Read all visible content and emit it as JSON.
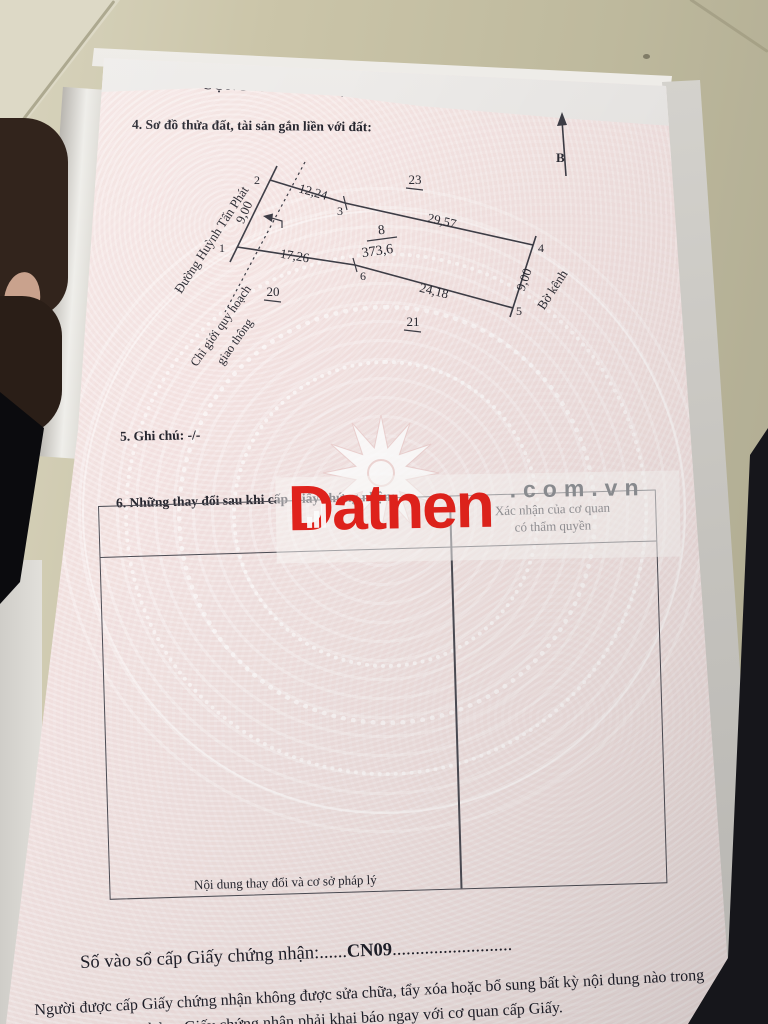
{
  "document": {
    "header_partial": "CỘNG HOÀ XÃ HỘI CHỦ NGHĨA VIỆT NAM",
    "section4": {
      "title": "4. Sơ đồ thửa đất, tài sản gắn liền với đất:"
    },
    "section5": {
      "label": "5. Ghi chú:",
      "value": "-/-"
    },
    "section6": {
      "title": "6. Những thay đổi sau khi cấp Giấy chứng nhận:",
      "table": {
        "col1_header": "Nội dung thay đổi và cơ sở pháp lý",
        "col2_header_line1": "Xác nhận của cơ quan",
        "col2_header_line2": "có thẩm quyền"
      }
    },
    "footer": {
      "registry_label": "Số vào sổ cấp Giấy chứng nhận:",
      "registry_dots_before": "......",
      "registry_number": "CN09",
      "registry_dots_after": "..........................",
      "notice_line1": "Người được cấp Giấy chứng nhận không được sửa chữa, tẩy xóa hoặc bổ sung bất kỳ nội dung nào trong",
      "notice_line2_partial": "hỏng Giấy chứng nhận phải khai báo ngay với cơ quan cấp Giấy."
    }
  },
  "diagram": {
    "north_label": "B",
    "road_label": "Đường Huỳnh Tấn Phát",
    "canal_label": "Bờ kênh",
    "planning_line1": "Chỉ giới quy hoạch",
    "planning_line2": "giao thông",
    "parcel": {
      "number": "8",
      "area": "373,6"
    },
    "points": {
      "p1": "1",
      "p2": "2",
      "p3": "3",
      "p4": "4",
      "p5": "5",
      "p6": "6"
    },
    "lengths": {
      "top1": "12,24",
      "top2": "29,57",
      "bottom1": "17,26",
      "bottom2": "24,18",
      "left": "9,00",
      "right": "9,00"
    },
    "neighbors": {
      "top": "23",
      "left": "20",
      "bottom": "21"
    }
  },
  "watermark": {
    "brand": "Datnen",
    "domain": ".com.vn",
    "accent_color": "#e3231c"
  },
  "colors": {
    "paper_pink": "#f4e4e3",
    "floor_tan": "#c9c3a6"
  }
}
